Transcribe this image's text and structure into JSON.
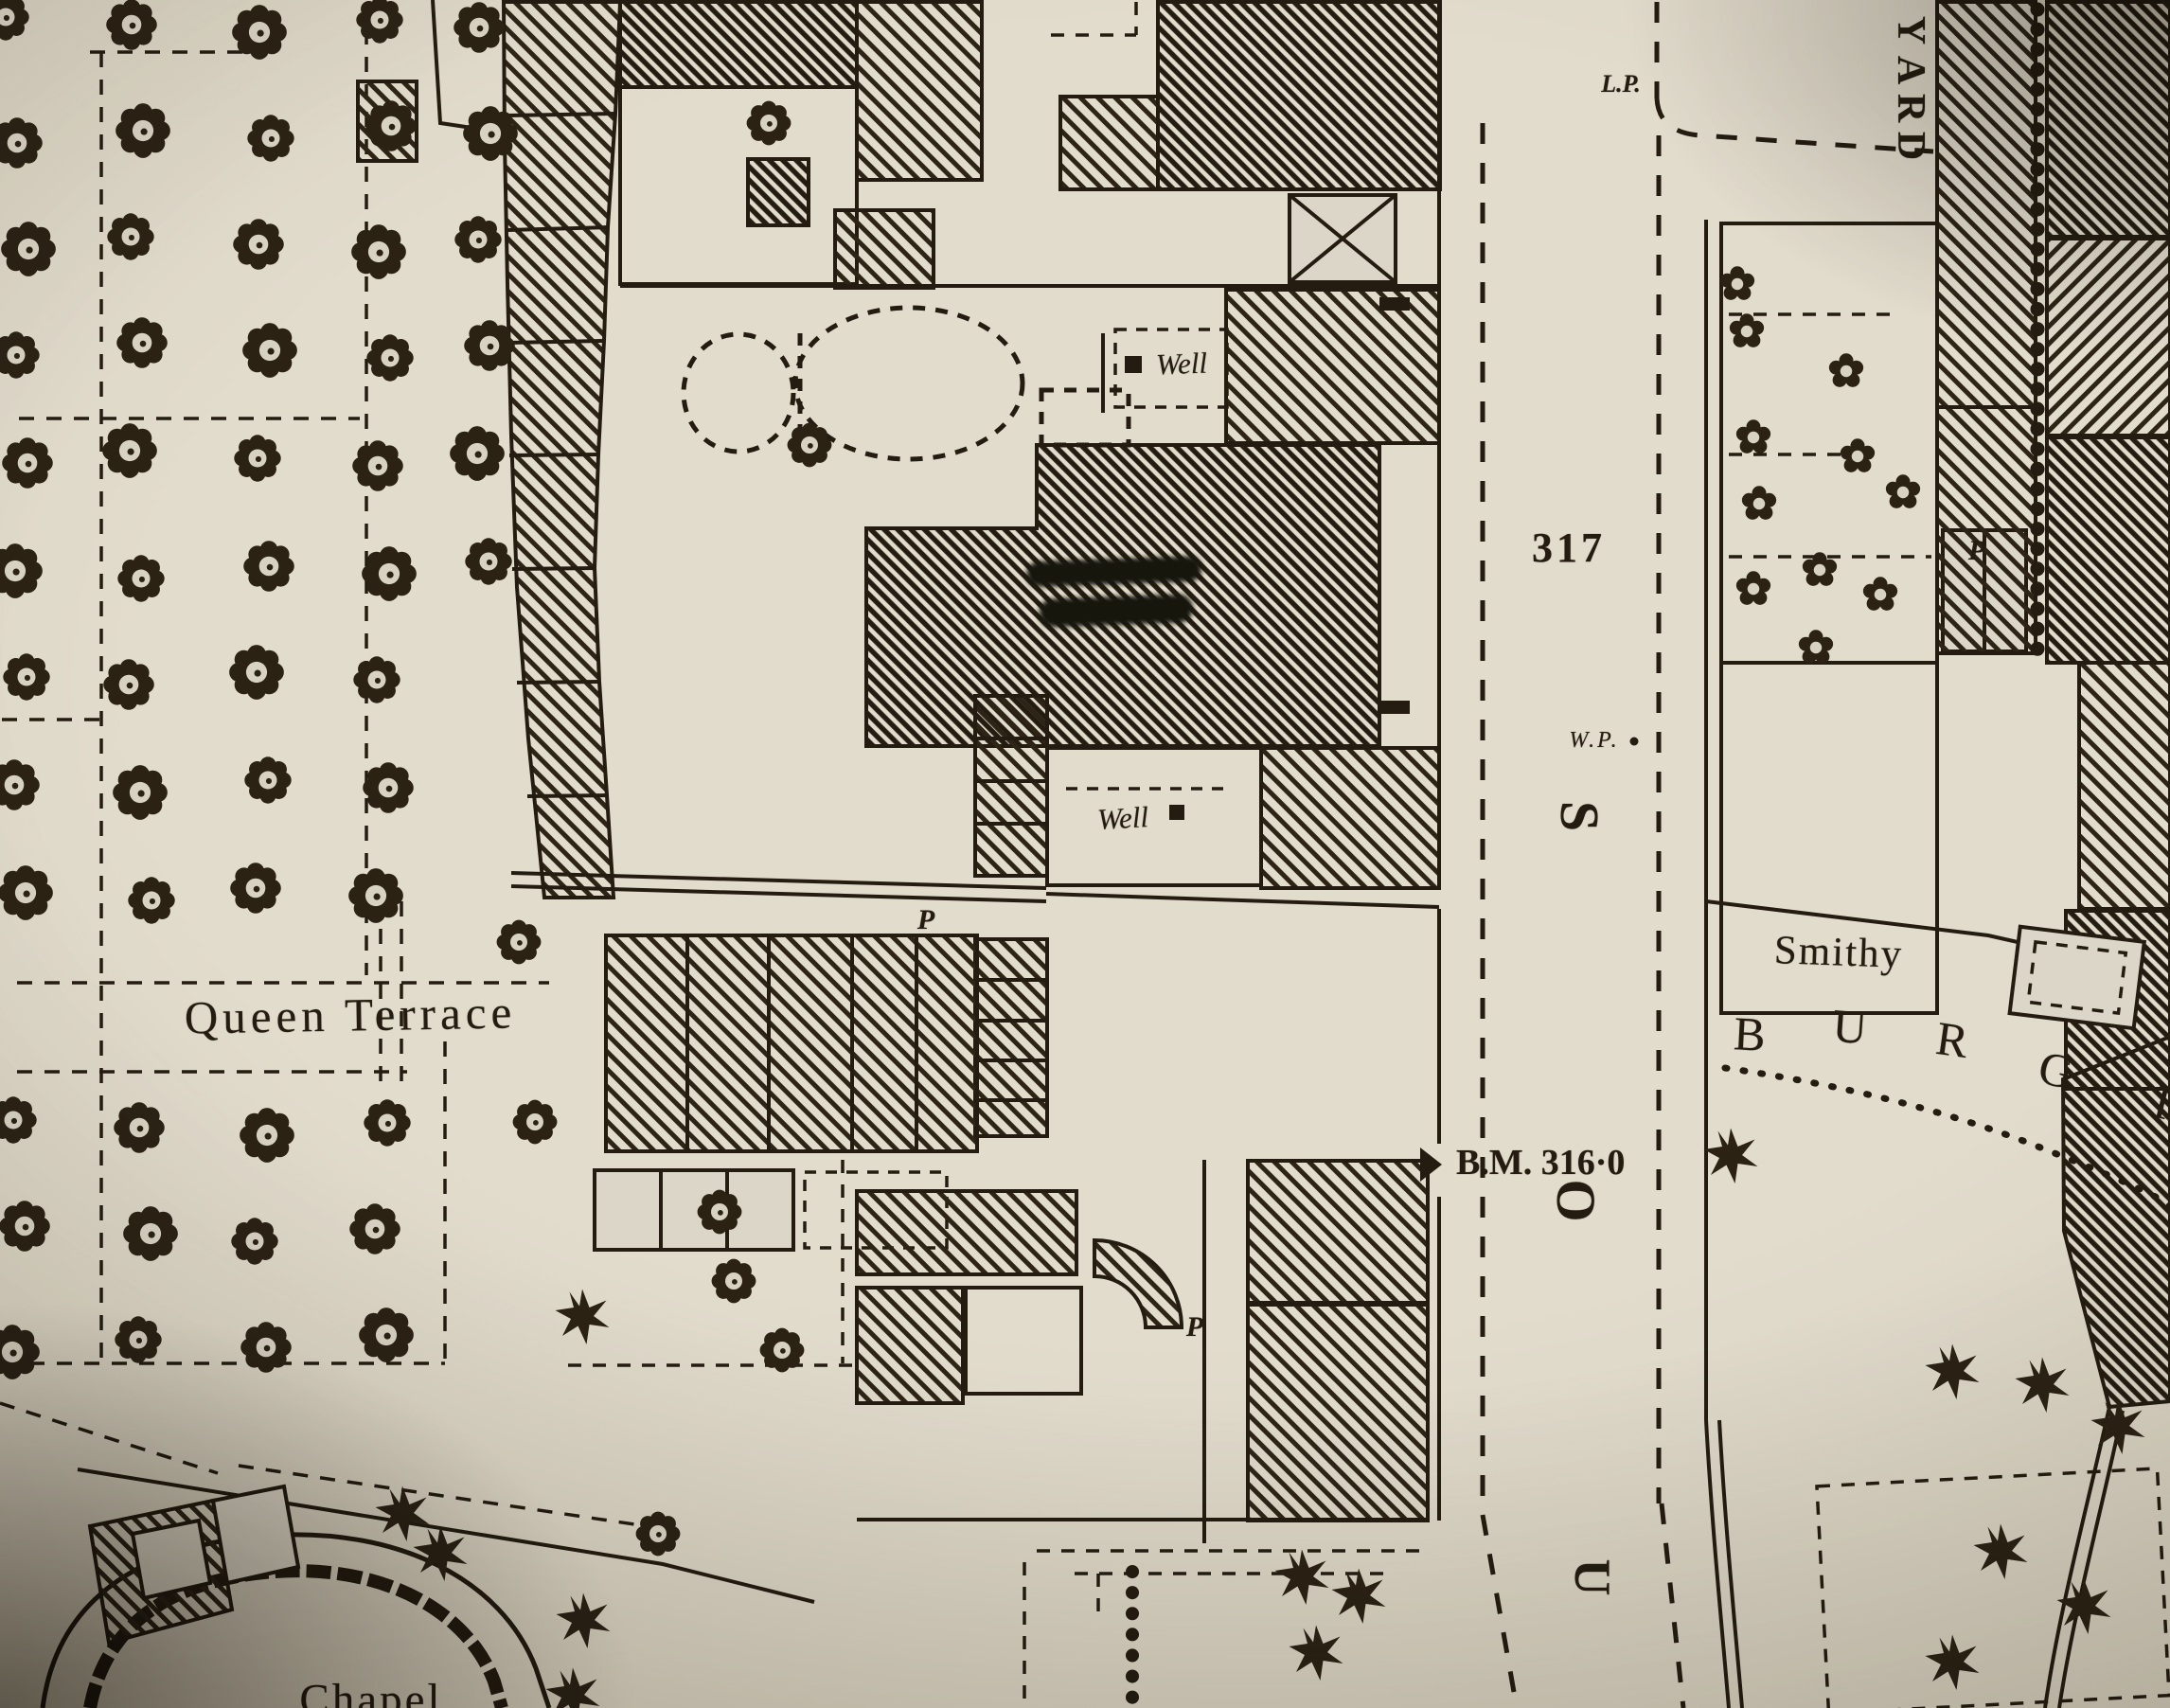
{
  "title": "Scanned vintage town-plan map extract",
  "colors": {
    "paper": "#dcd6c8",
    "ink": "#241c10"
  },
  "labels": {
    "queen_terrace": "Queen Terrace",
    "chapel": "Chapel",
    "smithy": "Smithy",
    "yard": {
      "letters": [
        "Y",
        "A",
        "R",
        "D"
      ]
    },
    "street_vertical": {
      "letters": [
        "S",
        "O",
        "U"
      ]
    },
    "street_curved": {
      "letters": [
        "B",
        "U",
        "R",
        "G",
        "I"
      ]
    },
    "lamp_post_abbrev": "L.P.",
    "water_pump_abbrev": "W.P.",
    "benchmark": "B.M. 316·0",
    "parcel_number": "317",
    "well_upper": "Well",
    "well_lower": "Well",
    "pump_marker_1": "P",
    "pump_marker_2": "P",
    "pump_marker_3": "P"
  }
}
